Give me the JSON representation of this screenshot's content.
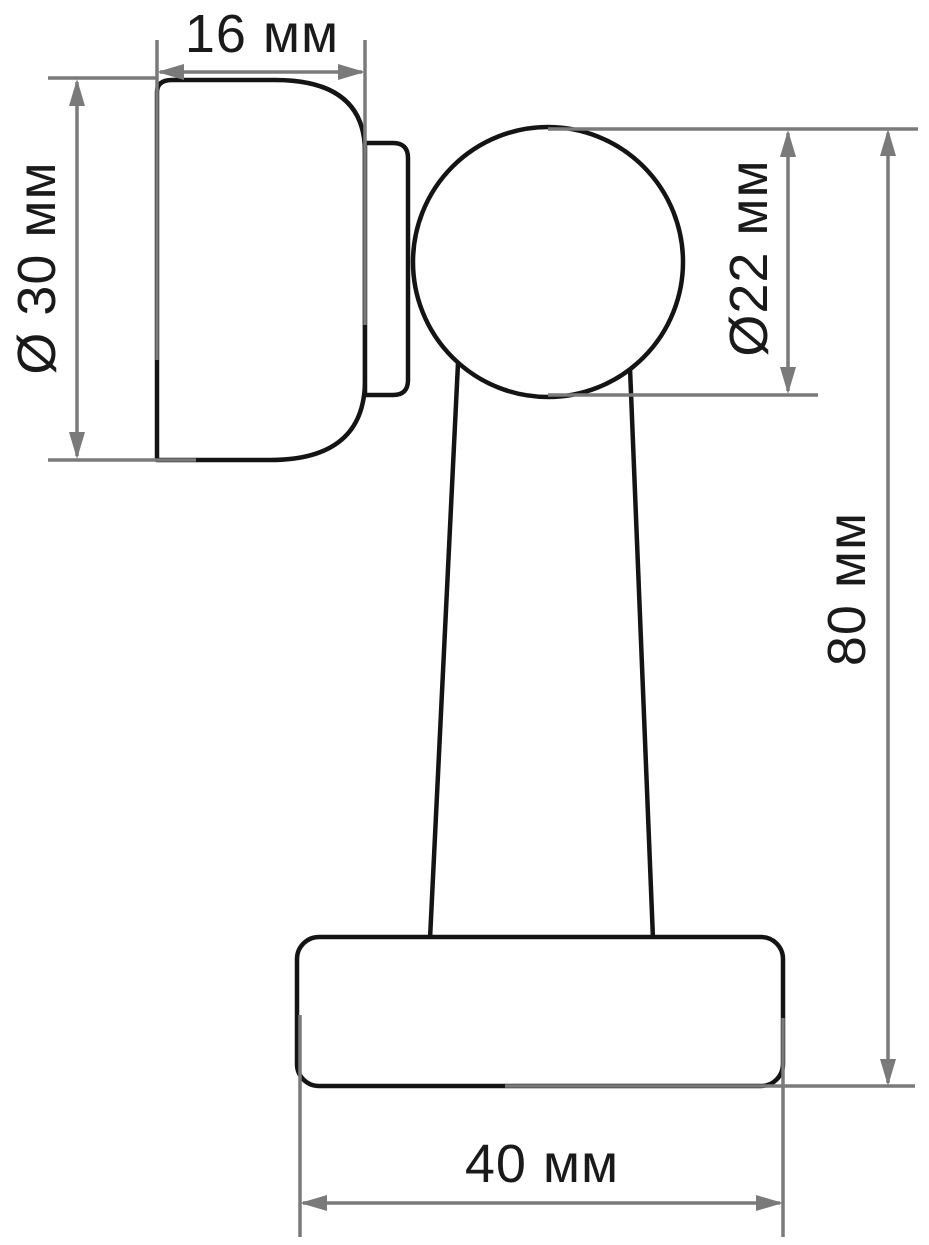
{
  "drawing": {
    "unit": "мм",
    "background_color": "#ffffff",
    "outline_color": "#141414",
    "dimension_line_color": "#7a7a7a",
    "label_color": "#1a1a1a",
    "dimensions": {
      "flange_width": {
        "label": "16 мм",
        "value": 16,
        "orientation": "horizontal"
      },
      "flange_diameter": {
        "label": "Ø 30 мм",
        "value": 30,
        "orientation": "vertical"
      },
      "ball_diameter": {
        "label": "Ø22 мм",
        "value": 22,
        "orientation": "vertical"
      },
      "overall_height": {
        "label": "80 мм",
        "value": 80,
        "orientation": "vertical"
      },
      "base_width": {
        "label": "40 мм",
        "value": 40,
        "orientation": "horizontal"
      }
    }
  }
}
